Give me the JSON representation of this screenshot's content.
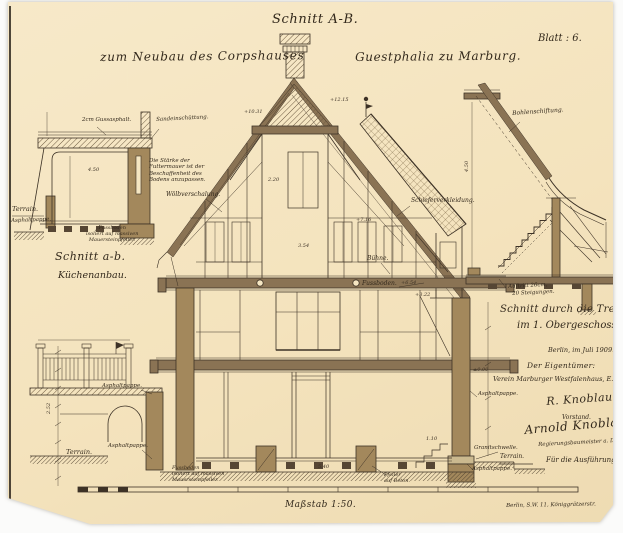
{
  "header": {
    "title": "Schnitt A-B.",
    "subtitle_left": "zum Neubau des Corpshauses",
    "subtitle_right": "Guestphalia zu Marburg.",
    "sheet_no": "Blatt : 6.",
    "edge_mark": "36"
  },
  "kitchen": {
    "title": "Schnitt a-b.",
    "subtitle": "Küchenanbau.",
    "label_gussasphalt": "2cm Gussasphalt.",
    "label_sand": "Sandeinschüttung.",
    "label_terrain": "Terrain.",
    "label_asphaltpappe": "Asphaltpappe.",
    "note_line1": "Die Stärke der",
    "note_line2": "Futtermauer ist der",
    "note_line3": "Beschaffenheit des",
    "note_line4": "Bodens anzupassen.",
    "floor_line1": "Fussboden",
    "floor_line2": "isoliert auf massiven",
    "floor_line3": "Mauersteinpfeiler."
  },
  "main": {
    "label_woelbverschalung": "Wölbverschalung.",
    "label_schieferverkleidung": "Schieferverkleidung.",
    "label_buehne": "Bühne.",
    "label_fussboden": "Fussboden.",
    "label_asphalt_fence": "Asphaltpappe.",
    "label_asphalt_arch": "Asphaltpappe.",
    "label_terrain_left": "Terrain.",
    "label_granitschwelle": "Granitschwelle.",
    "label_terrain_right": "Terrain.",
    "label_asphalt_right_top": "Asphaltpappe.",
    "label_asphalt_right_bottom": "Asphaltpappe.",
    "floor_line1": "Fussboden",
    "floor_line2": "isoliert auf massiven",
    "floor_line3": "Mauersteinpfeiler.",
    "pier_line1": "Pfeiler",
    "pier_line2": "auf Beton."
  },
  "stairs": {
    "title_line1": "Schnitt durch die Treppe",
    "title_line2": "im 1. Obergeschoss.",
    "label_bohlenschiftung": "Bohlenschiftung.",
    "label_auftritt_line1": "Auftritt 26cm,",
    "label_auftritt_line2": "20 Steigungen."
  },
  "legal": {
    "date": "Berlin, im Juli 1909.",
    "owner_heading": "Der Eigentümer:",
    "owner_name": "Verein Marburger Westfalenhaus, E.V.",
    "signature1": "R. Knoblauch.",
    "signature1_role": "Vorstand.",
    "signature2": "Arnold Knoblauch",
    "signature2_role": "Regierungsbaumeister a. D.",
    "execution_heading": "Für die Ausführung:"
  },
  "footer": {
    "scale": "Maßstab 1:50.",
    "address": "Berlin, S.W. 11, Königgrätzerstr."
  },
  "colors": {
    "paper": "#f5e6c2",
    "ink": "#3d3226",
    "wall_fill": "#a3885c",
    "dark_wood": "#8a7354"
  },
  "annotations": [
    {
      "t": "+12.15",
      "x": 330,
      "y": 97
    },
    {
      "t": "+10.31",
      "x": 244,
      "y": 109
    },
    {
      "t": "+7.16",
      "x": 356,
      "y": 217
    },
    {
      "t": "+6.54",
      "x": 401,
      "y": 280
    },
    {
      "t": "+3.22",
      "x": 415,
      "y": 292
    },
    {
      "t": "2.20",
      "x": 268,
      "y": 177
    },
    {
      "t": "3.54",
      "x": 298,
      "y": 243
    },
    {
      "t": "4.50",
      "x": 88,
      "y": 167
    },
    {
      "t": "±0.00",
      "x": 473,
      "y": 367
    },
    {
      "t": "4.50",
      "x": 464,
      "y": 172,
      "r": -90
    },
    {
      "t": "2.52",
      "x": 46,
      "y": 414,
      "r": -90
    },
    {
      "t": "5.40",
      "x": 318,
      "y": 464
    },
    {
      "t": "1.10",
      "x": 426,
      "y": 436
    }
  ]
}
